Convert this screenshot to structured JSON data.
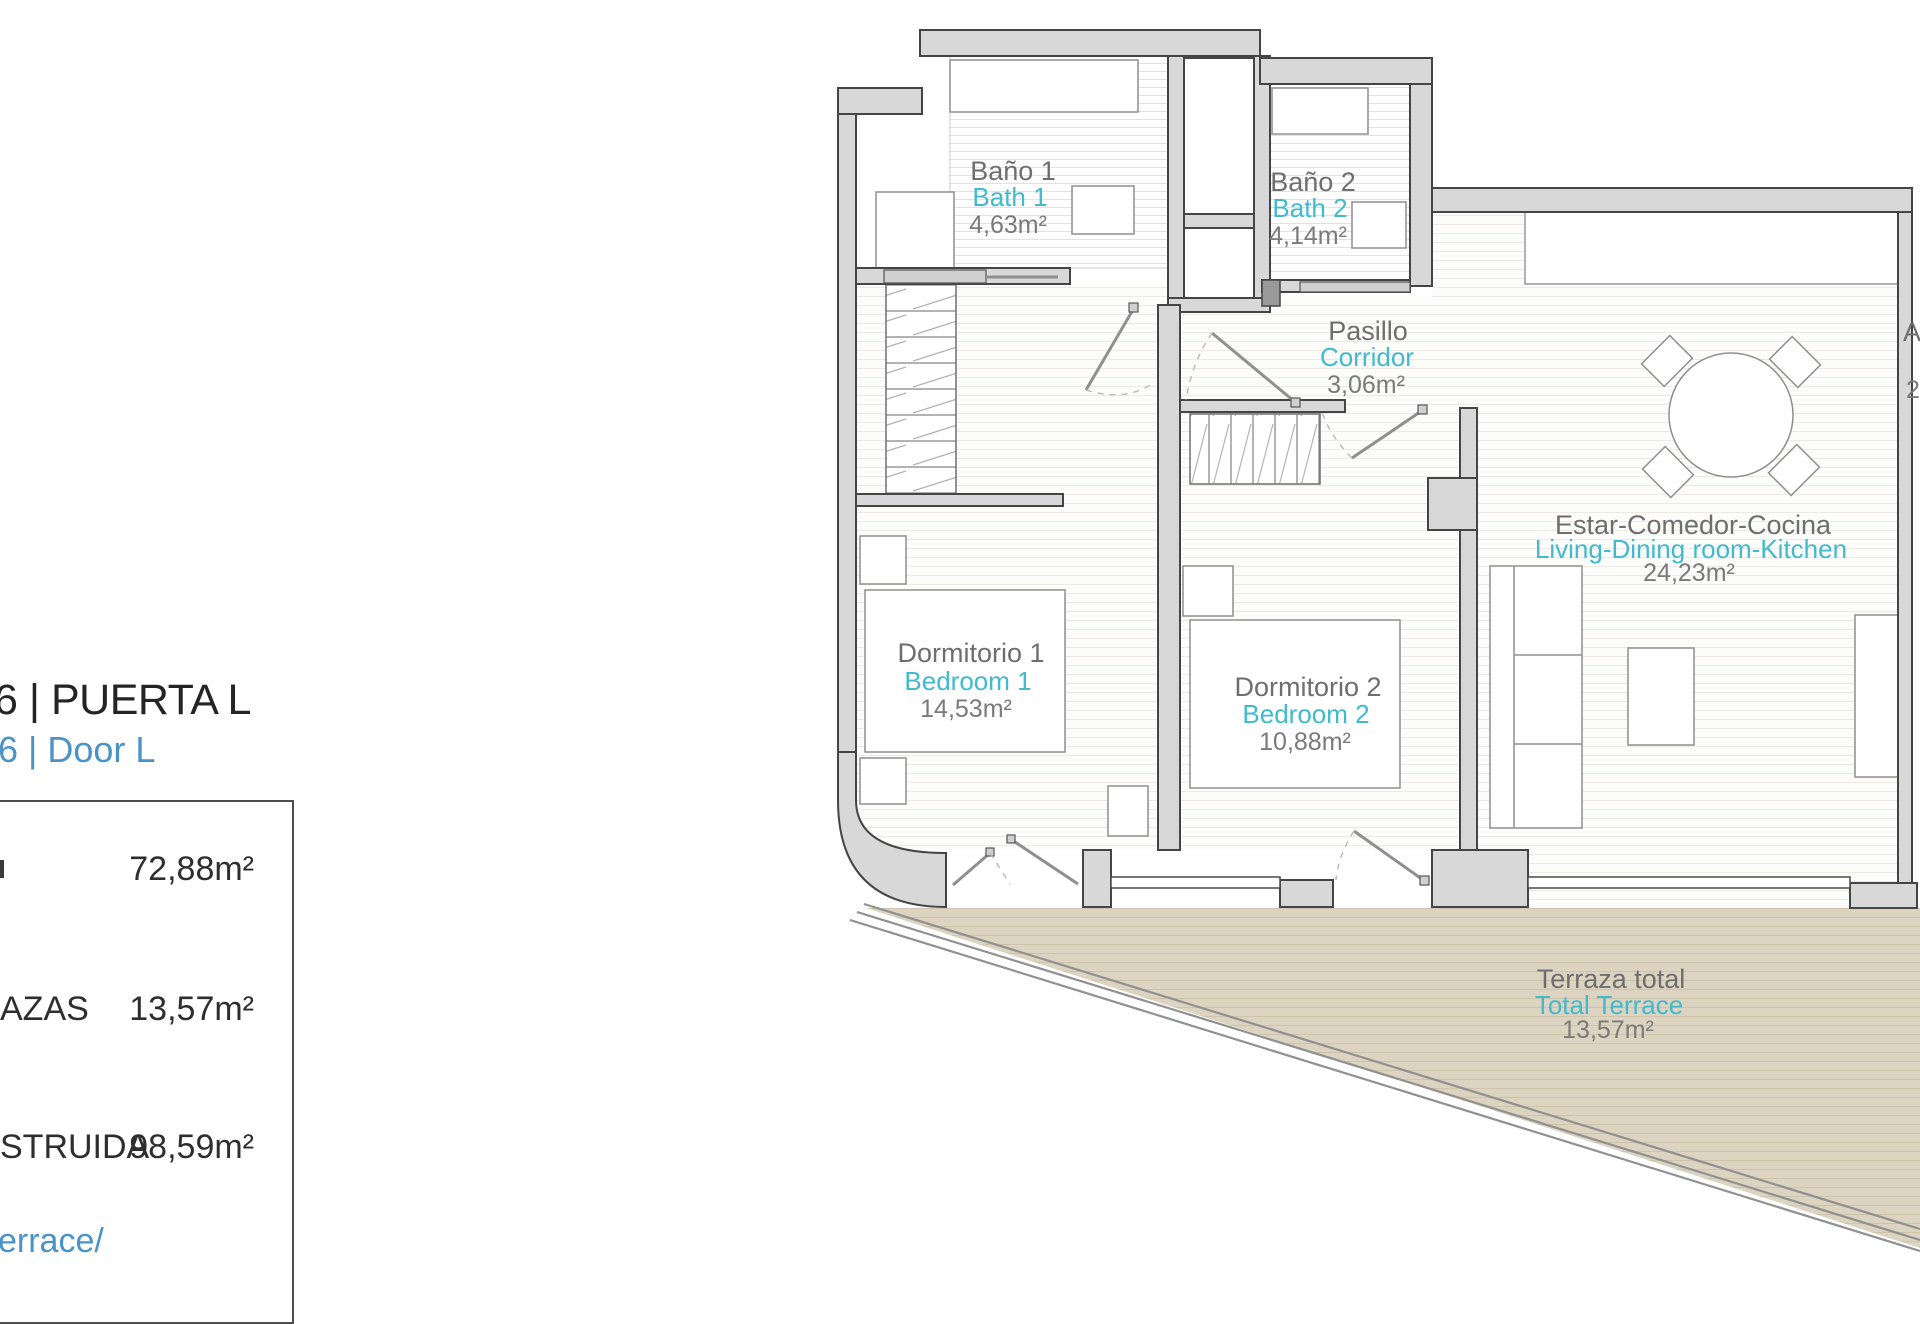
{
  "panel": {
    "title": "6 | PUERTA L",
    "subtitle": "6 | Door L",
    "rows": [
      {
        "label": "",
        "value": "72,88m²"
      },
      {
        "label": "AZAS",
        "value": "13,57m²"
      },
      {
        "label": "STRUIDA",
        "value": "98,59m²"
      }
    ],
    "footer": "errace/"
  },
  "plan": {
    "rooms": [
      {
        "id": "bath1",
        "name_es": "Baño 1",
        "name_en": "Bath 1",
        "area": "4,63m²"
      },
      {
        "id": "bath2",
        "name_es": "Baño 2",
        "name_en": "Bath 2",
        "area": "4,14m²"
      },
      {
        "id": "corridor",
        "name_es": "Pasillo",
        "name_en": "Corridor",
        "area": "3,06m²"
      },
      {
        "id": "bedroom1",
        "name_es": "Dormitorio 1",
        "name_en": "Bedroom 1",
        "area": "14,53m²"
      },
      {
        "id": "bedroom2",
        "name_es": "Dormitorio 2",
        "name_en": "Bedroom 2",
        "area": "10,88m²"
      },
      {
        "id": "living",
        "name_es": "Estar-Comedor-Cocina",
        "name_en": "Living-Dining room-Kitchen",
        "area": "24,23m²"
      },
      {
        "id": "terrace",
        "name_es": "Terraza total",
        "name_en": "Total Terrace",
        "area": "13,57m²"
      }
    ],
    "edge_fragments": {
      "a": "A",
      "b": "2"
    }
  },
  "colors": {
    "accent_blue": "#4a93c8",
    "accent_cyan": "#41bace",
    "wall_gray": "#d8d8d8",
    "terrace_beige": "#dcd3c1"
  }
}
